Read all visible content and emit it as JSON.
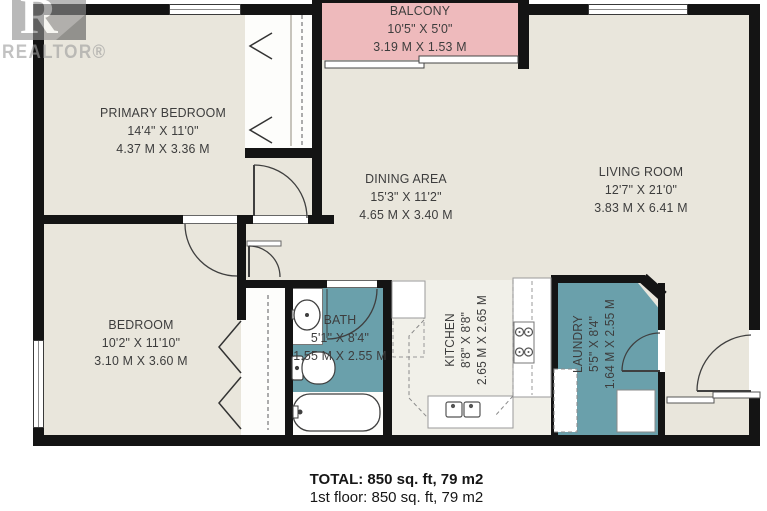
{
  "watermark": {
    "logo_letter": "R",
    "label": "REALTOR®"
  },
  "rooms": [
    {
      "id": "balcony",
      "name": "BALCONY",
      "dim_ft": "10'5\" X 5'0\"",
      "dim_m": "3.19 M X 1.53 M"
    },
    {
      "id": "primary-bedroom",
      "name": "PRIMARY BEDROOM",
      "dim_ft": "14'4\" X 11'0\"",
      "dim_m": "4.37 M X 3.36 M"
    },
    {
      "id": "living-room",
      "name": "LIVING ROOM",
      "dim_ft": "12'7\" X 21'0\"",
      "dim_m": "3.83 M X 6.41 M"
    },
    {
      "id": "dining-area",
      "name": "DINING AREA",
      "dim_ft": "15'3\" X 11'2\"",
      "dim_m": "4.65 M X 3.40 M"
    },
    {
      "id": "bedroom",
      "name": "BEDROOM",
      "dim_ft": "10'2\" X 11'10\"",
      "dim_m": "3.10 M X 3.60 M"
    },
    {
      "id": "bath",
      "name": "BATH",
      "dim_ft": "5'1\" X 8'4\"",
      "dim_m": "1.55 M X 2.55 M"
    },
    {
      "id": "kitchen",
      "name": "KITCHEN",
      "dim_ft": "8'8\" X 8'8\"",
      "dim_m": "2.65 M X 2.65 M"
    },
    {
      "id": "laundry",
      "name": "LAUNDRY",
      "dim_ft": "5'5\" X 8'4\"",
      "dim_m": "1.64 M X 2.55 M"
    }
  ],
  "summary": {
    "total": "TOTAL: 850 sq. ft, 79 m2",
    "floor1": "1st floor: 850 sq. ft, 79 m2"
  },
  "colors": {
    "floor": "#e9e6dc",
    "balcony": "#eebabc",
    "wet": "#6aa0ab",
    "kitchen_floor": "#f1f0e9",
    "wall": "#141414"
  }
}
